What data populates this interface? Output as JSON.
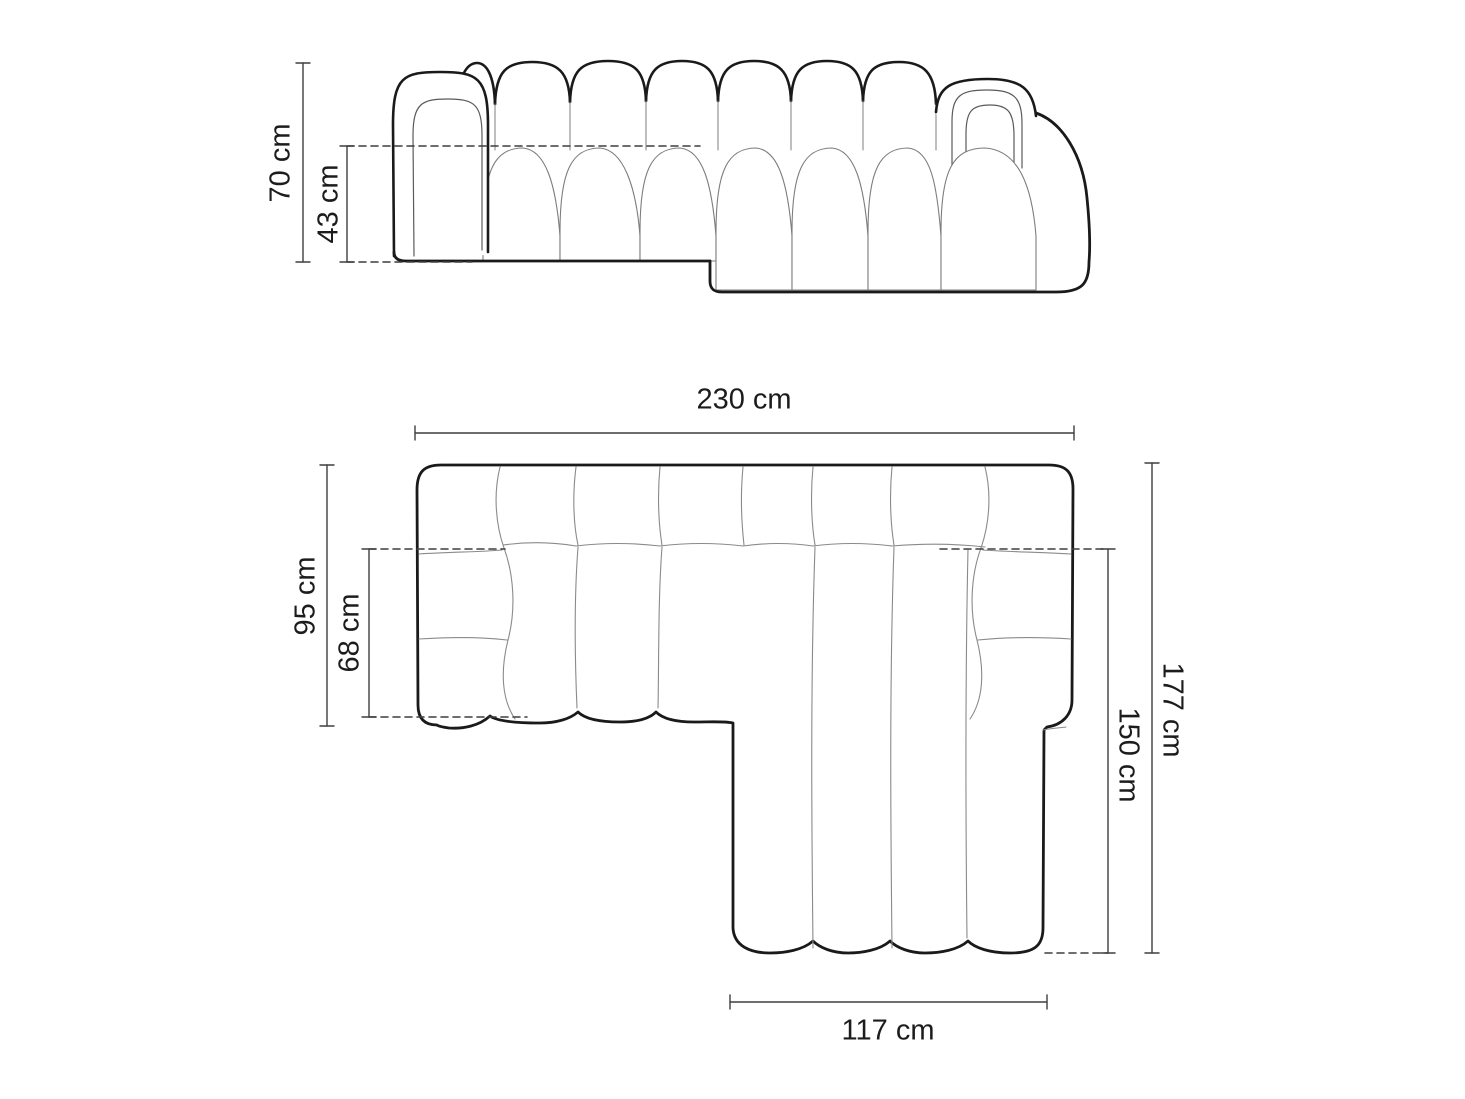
{
  "diagram": {
    "type": "furniture-dimension-drawing",
    "subject": "corner-sofa-with-left-chaise",
    "units": "cm",
    "views": [
      {
        "id": "side-elevation",
        "position": "top"
      },
      {
        "id": "top-plan",
        "position": "bottom"
      }
    ],
    "colors": {
      "background": "#ffffff",
      "outline": "#1a1a1a",
      "thin_line": "#8a8a8a",
      "inner_arm_line": "#5a5a5a",
      "dimension_line": "#3f3f3f",
      "text": "#1c1c1c"
    }
  },
  "dimensions": {
    "height": {
      "label": "70 cm",
      "value": 70,
      "unit": "cm",
      "view": "side-elevation"
    },
    "seat_height": {
      "label": "43 cm",
      "value": 43,
      "unit": "cm",
      "view": "side-elevation"
    },
    "width": {
      "label": "230 cm",
      "value": 230,
      "unit": "cm",
      "view": "top-plan"
    },
    "depth": {
      "label": "95 cm",
      "value": 95,
      "unit": "cm",
      "view": "top-plan"
    },
    "seat_depth": {
      "label": "68 cm",
      "value": 68,
      "unit": "cm",
      "view": "top-plan"
    },
    "overall_depth": {
      "label": "177 cm",
      "value": 177,
      "unit": "cm",
      "view": "top-plan"
    },
    "chaise_depth": {
      "label": "150 cm",
      "value": 150,
      "unit": "cm",
      "view": "top-plan"
    },
    "chaise_width": {
      "label": "117 cm",
      "value": 117,
      "unit": "cm",
      "view": "top-plan"
    }
  }
}
